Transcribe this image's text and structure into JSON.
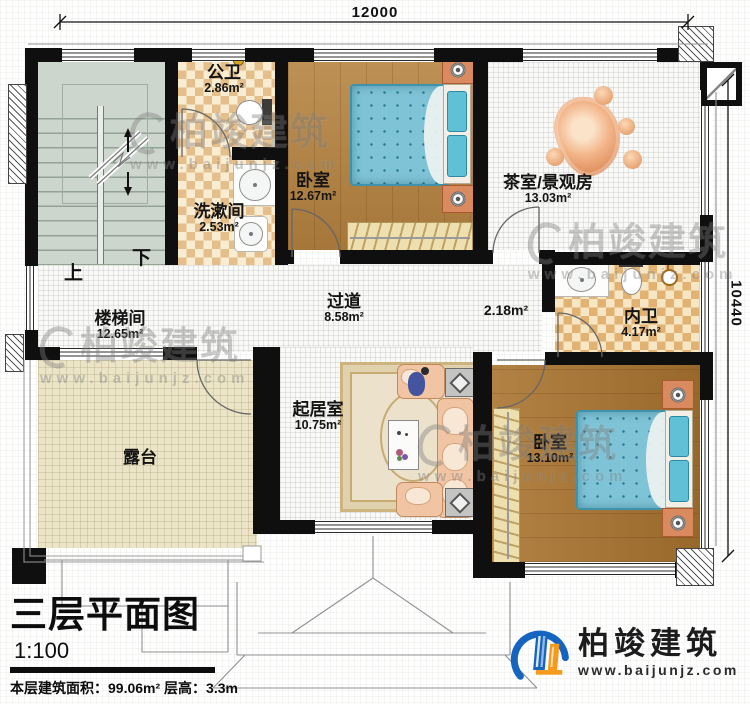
{
  "dimensions": {
    "top": "12000",
    "right": "10440"
  },
  "rooms": {
    "stairwell": {
      "name": "楼梯间",
      "area": "12.65m²"
    },
    "public_bath": {
      "name": "公卫",
      "area": "2.86m²"
    },
    "washroom": {
      "name": "洗漱间",
      "area": "2.53m²"
    },
    "bedroom_top": {
      "name": "卧室",
      "area": "12.67m²"
    },
    "tearoom": {
      "name": "茶室/景观房",
      "area": "13.03m²"
    },
    "hallway": {
      "name": "过道",
      "area": "8.58m²"
    },
    "nook": {
      "area": "2.18m²"
    },
    "inner_bath": {
      "name": "内卫",
      "area": "4.17m²"
    },
    "living": {
      "name": "起居室",
      "area": "10.75m²"
    },
    "bedroom_bottom": {
      "name": "卧室",
      "area": "13.10m²"
    },
    "terrace": {
      "name": "露台"
    }
  },
  "stairs": {
    "up": "上",
    "down": "下"
  },
  "title_block": {
    "title": "三层平面图",
    "scale": "1:100",
    "area_line": "本层建筑面积：99.06m²",
    "height_line": "层高：3.3m"
  },
  "branding": {
    "logo_text": "柏竣建筑",
    "logo_url": "www.baijunjz.com"
  },
  "watermark": {
    "text": "柏竣建筑",
    "url": "www.baijunjz.com"
  },
  "colors": {
    "wall": "#0f0f0f",
    "wood": "#b4813e",
    "tile_checker": "#e5bf8b",
    "stair_floor": "#cdd6cc",
    "terrace": "#ebe4c6",
    "bed_blue": "#7fc3d6",
    "sofa_peach": "#f1c5a3",
    "logo_blue": "#1565c0",
    "logo_orange": "#f59a1b"
  }
}
